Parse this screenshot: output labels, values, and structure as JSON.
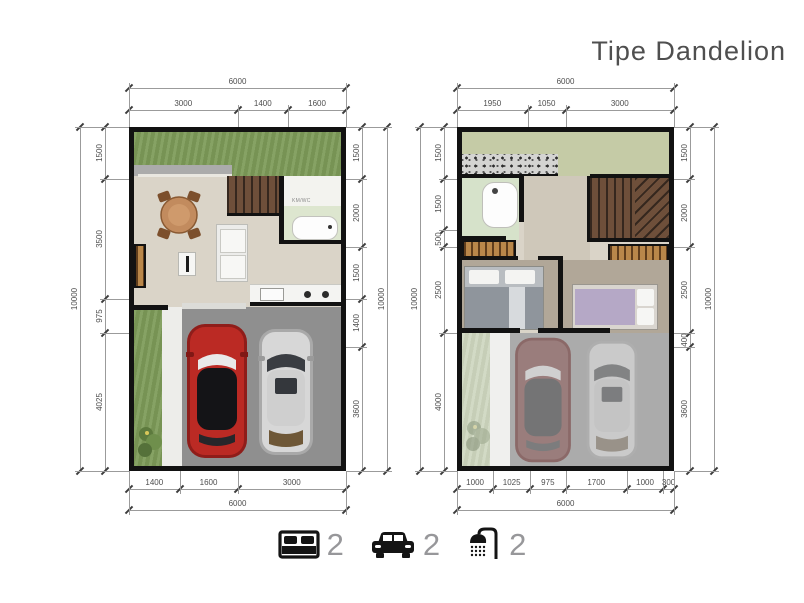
{
  "title": "Tipe Dandelion",
  "plans": {
    "left": {
      "label": "ground floor",
      "bathroom_label": "KM/WC"
    },
    "right": {
      "label": "upper floor"
    }
  },
  "dimensions": [
    {
      "plan": "left",
      "side": "top",
      "type": "overall",
      "values": [
        "6000"
      ]
    },
    {
      "plan": "left",
      "side": "top",
      "type": "segments",
      "values": [
        "3000",
        "1400",
        "1600"
      ]
    },
    {
      "plan": "left",
      "side": "left",
      "type": "overall",
      "values": [
        "10000"
      ]
    },
    {
      "plan": "left",
      "side": "left",
      "type": "segments",
      "values": [
        "1500",
        "3500",
        "975",
        "4025"
      ]
    },
    {
      "plan": "left",
      "side": "right",
      "type": "segments",
      "values": [
        "1500",
        "2000",
        "1500",
        "1400",
        "3600"
      ]
    },
    {
      "plan": "left",
      "side": "right",
      "type": "overall",
      "values": [
        "10000"
      ]
    },
    {
      "plan": "left",
      "side": "bottom",
      "type": "segments",
      "values": [
        "1400",
        "1600",
        "3000"
      ]
    },
    {
      "plan": "left",
      "side": "bottom",
      "type": "overall",
      "values": [
        "6000"
      ]
    },
    {
      "plan": "right",
      "side": "top",
      "type": "overall",
      "values": [
        "6000"
      ]
    },
    {
      "plan": "right",
      "side": "top",
      "type": "segments",
      "values": [
        "1950",
        "1050",
        "3000"
      ]
    },
    {
      "plan": "right",
      "side": "left",
      "type": "overall",
      "values": [
        "10000"
      ]
    },
    {
      "plan": "right",
      "side": "left",
      "type": "segments",
      "values": [
        "1500",
        "1500",
        "500",
        "2500",
        "4000"
      ]
    },
    {
      "plan": "right",
      "side": "right",
      "type": "segments",
      "values": [
        "1500",
        "2000",
        "2500",
        "400",
        "3600"
      ]
    },
    {
      "plan": "right",
      "side": "right",
      "type": "overall",
      "values": [
        "10000"
      ]
    },
    {
      "plan": "right",
      "side": "bottom",
      "type": "segments",
      "values": [
        "1000",
        "1025",
        "975",
        "1700",
        "1000",
        "300"
      ]
    },
    {
      "plan": "right",
      "side": "bottom",
      "type": "overall",
      "values": [
        "6000"
      ]
    }
  ],
  "legend": {
    "items": [
      {
        "icon": "bed-icon",
        "count": "2"
      },
      {
        "icon": "car-icon",
        "count": "2"
      },
      {
        "icon": "shower-icon",
        "count": "2"
      }
    ]
  },
  "colors": {
    "wall": "#121212",
    "grass": "#7d9b58",
    "garage": "#8f8f8f",
    "floor": "#dad4c8",
    "car_accent": "#bb2a24"
  }
}
